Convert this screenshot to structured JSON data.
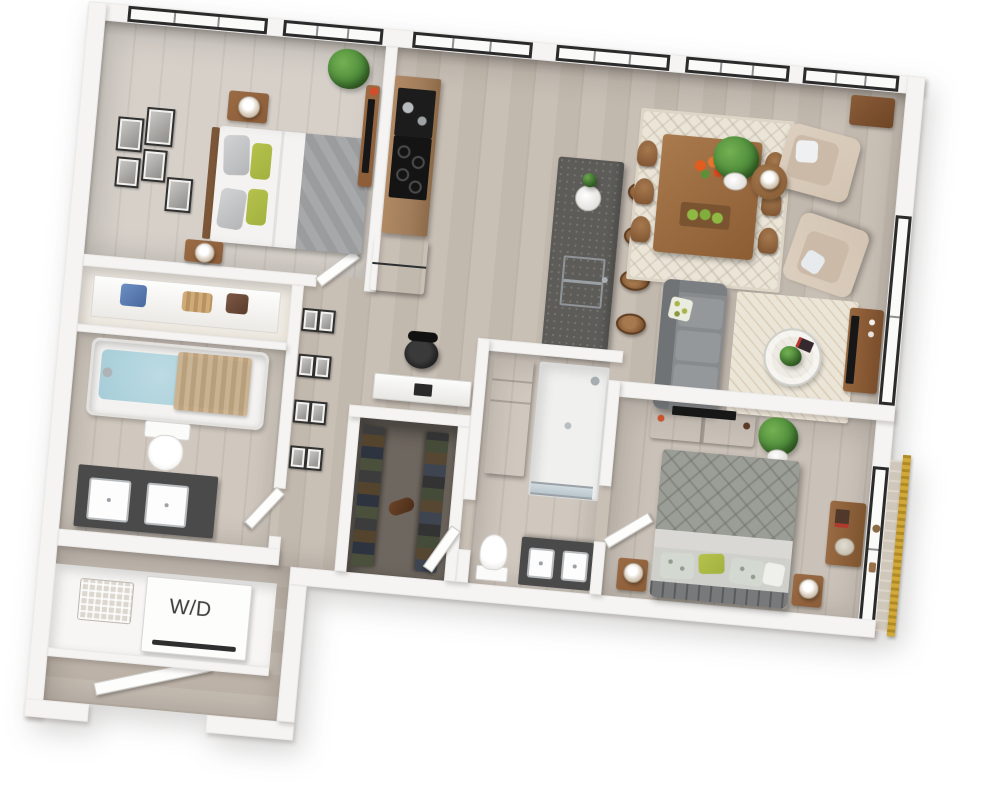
{
  "floor_plan": {
    "type": "3d-rendered-apartment-floor-plan",
    "label_wd": "W/D",
    "colors": {
      "wall": "#f5f4f2",
      "floor_main": "#c8bfb5",
      "floor_plank": "#bdb3a8",
      "floor_wing": "#c3bab0",
      "floor_bed1": "#d6d0c9",
      "floor_bed2": "#cac2b8",
      "floor_closet": "#6e675f",
      "window_frame": "#2b2b2b",
      "glass": "#fafaf9",
      "island_top": "#5d5c59",
      "cabinet_wood": "#a07c5b",
      "wood_mid": "#9a6b44",
      "wood_dark": "#8a5c38",
      "sofa_gray": "#878b8e",
      "bed_blanket": "#9b9d97",
      "bed_throw": "#a7a8aa",
      "accent_green": "#a2b13f",
      "beige": "#d3c4b2",
      "rug_cream": "#ebe5d8",
      "vanity_dark": "#4a4a4a",
      "water_blue": "#a7cdd8",
      "gold": "#d2a838",
      "tv_black": "#171717",
      "plant": "#4e8c3a",
      "stainless": "#c6cacc"
    },
    "rooms": [
      {
        "name": "bedroom-1",
        "furniture": [
          "bed",
          "nightstand-2x",
          "table-lamp-2x",
          "wall-art-frames",
          "dresser-with-tv",
          "potted-plant",
          "corner-windows"
        ]
      },
      {
        "name": "kitchen",
        "furniture": [
          "wall-cabinets",
          "wall-oven",
          "cooktop",
          "refrigerator",
          "island-with-sink",
          "bar-stools-4x",
          "vase-plant"
        ]
      },
      {
        "name": "dining-area",
        "furniture": [
          "dining-table",
          "dining-chairs-6x",
          "area-rug",
          "flower-centerpiece",
          "fruit-bowl"
        ]
      },
      {
        "name": "living-room",
        "furniture": [
          "sofa",
          "armchair-2x",
          "round-side-table",
          "table-lamp",
          "area-rug",
          "round-glass-coffee-table",
          "tv-console-with-tv",
          "potted-plant",
          "corner-console"
        ]
      },
      {
        "name": "bedroom-2",
        "furniture": [
          "bed",
          "nightstand-2x",
          "table-lamp-2x",
          "dresser-with-tv",
          "potted-plant",
          "desk",
          "balcony-window",
          "gold-screen"
        ]
      },
      {
        "name": "bathroom-1",
        "furniture": [
          "bathtub",
          "toilet",
          "double-vanity"
        ]
      },
      {
        "name": "bathroom-2",
        "furniture": [
          "linen-cabinet",
          "glass-shower",
          "toilet",
          "double-vanity"
        ]
      },
      {
        "name": "walk-in-closet",
        "furniture": [
          "hanging-clothes",
          "duffel-bag"
        ]
      },
      {
        "name": "linen-closet",
        "furniture": [
          "shelf",
          "bags-and-baskets"
        ]
      },
      {
        "name": "laundry-closet",
        "furniture": [
          "washer-dryer",
          "wire-basket"
        ]
      },
      {
        "name": "hallway",
        "furniture": [
          "gallery-wall-frames",
          "desk-nook",
          "office-chair"
        ]
      },
      {
        "name": "entry",
        "furniture": [
          "entry-door"
        ]
      }
    ]
  }
}
